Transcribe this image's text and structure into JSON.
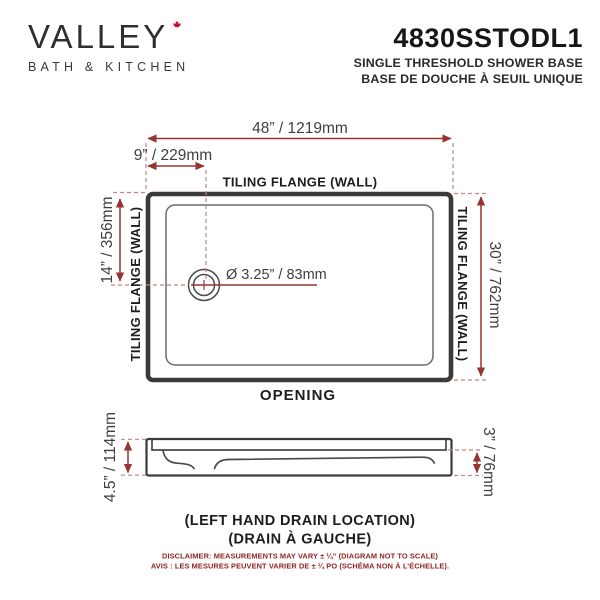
{
  "brand": {
    "name": "VALLEY",
    "tagline": "BATH & KITCHEN",
    "leaf_color": "#c8102e"
  },
  "product": {
    "model": "4830SSTODL1",
    "name_en": "SINGLE THRESHOLD SHOWER BASE",
    "name_fr": "BASE DE DOUCHE À SEUIL UNIQUE"
  },
  "top_view": {
    "width_label": "48” / 1219mm",
    "drain_offset_label": "9” / 229mm",
    "drain_from_top_label": "14” / 356mm",
    "depth_label": "30” / 762mm",
    "drain_diameter_label": "Ø 3.25” / 83mm",
    "flange_top": "TILING FLANGE (WALL)",
    "flange_left": "TILING FLANGE (WALL)",
    "flange_right": "TILING FLANGE (WALL)",
    "opening_label": "OPENING"
  },
  "side_view": {
    "height_label": "4.5” / 114mm",
    "threshold_label": "3” / 76mm",
    "caption_en": "(LEFT HAND DRAIN LOCATION)",
    "caption_fr": "(DRAIN À GAUCHE)"
  },
  "disclaimer": {
    "en": "DISCLAIMER: MEASUREMENTS MAY VARY ± ¼” (DIAGRAM NOT TO SCALE)",
    "fr": "AVIS : LES MESURES PEUVENT VARIER DE ± ¼ PO (SCHÉMA NON À L’ÉCHELLE)."
  },
  "colors": {
    "dimension_red": "#973330",
    "dashed_red": "#c5847e",
    "outline_dark": "#3a3a3a",
    "dimension_text": "#3f3f3f",
    "label_black": "#1d1d1d",
    "disclaimer_red": "#8e2420"
  }
}
